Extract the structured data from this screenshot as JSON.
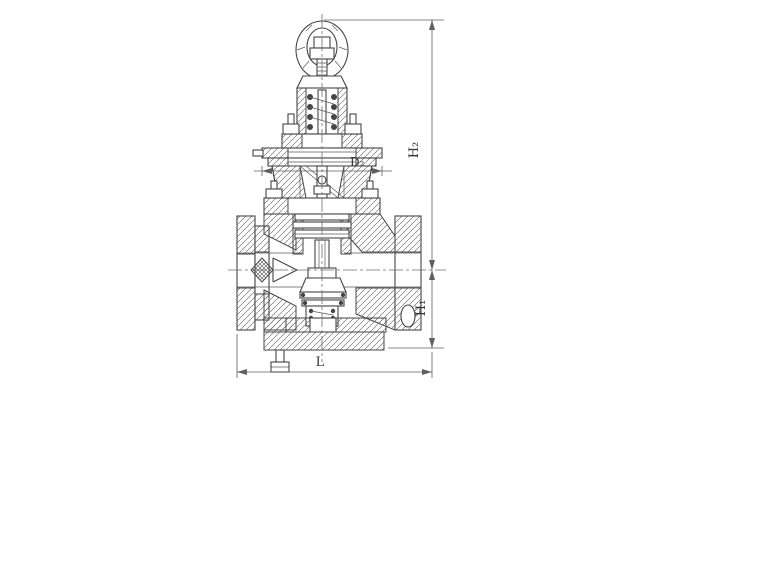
{
  "page": {
    "background": "#ffffff"
  },
  "drawing": {
    "line_color": "#454545",
    "hatch_color": "#5c5c5c",
    "dimension_color": "#5f5f5f",
    "dimensions": {
      "h2": {
        "label": "H₂"
      },
      "h1": {
        "label": "H₁"
      },
      "l": {
        "label": "L"
      },
      "d2": {
        "label": "D₂"
      }
    }
  }
}
